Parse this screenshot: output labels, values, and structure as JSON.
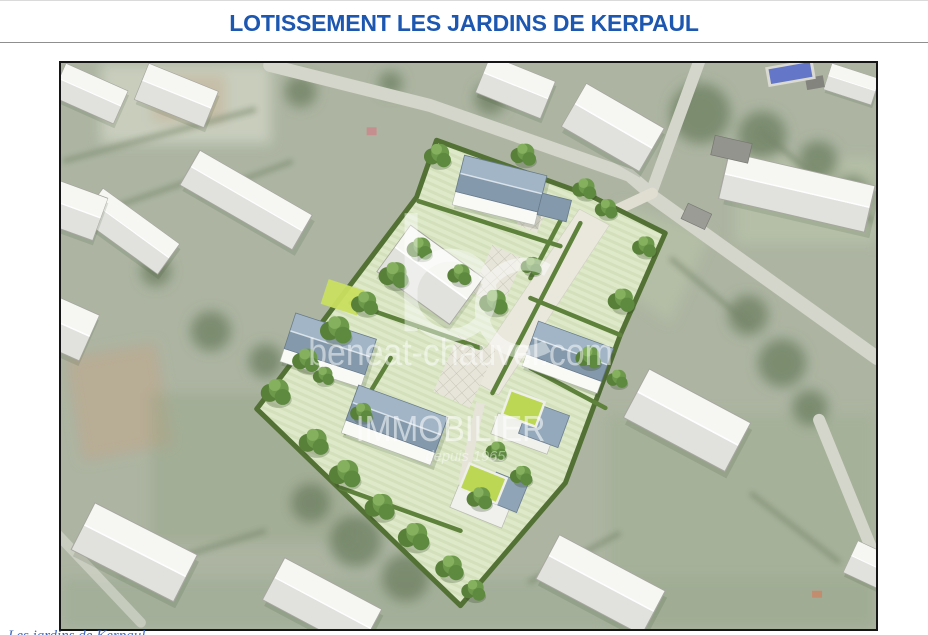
{
  "header": {
    "title": "LOTISSEMENT LES JARDINS DE KERPAUL",
    "title_color": "#1d57b0"
  },
  "plan": {
    "kind": "aerial-photo-with-3d-housing-development-render",
    "watermark": {
      "logo_initials": "bc",
      "website": "beneat-chauvel.com",
      "brand": "IMMOBILIER",
      "tagline": "depuis 1965"
    },
    "scene": {
      "new_houses_blue_roof": 4,
      "new_houses_green_flat_roof": 2,
      "existing_buildings_white": 14,
      "swimming_pool": 1,
      "hedged_lots": 6
    }
  },
  "footer": {
    "caption_partial": "Les jardins de Kerpaul"
  },
  "colors": {
    "title_blue": "#1d57b0",
    "hedge_green": "#4a6a2a",
    "lawn_green": "#dce8c6",
    "roof_blue_gray": "#8ca3b6",
    "green_roof_lime": "#b9d64a",
    "pool_blue": "#5b6fc5",
    "road_gray": "#d3d5ca"
  }
}
